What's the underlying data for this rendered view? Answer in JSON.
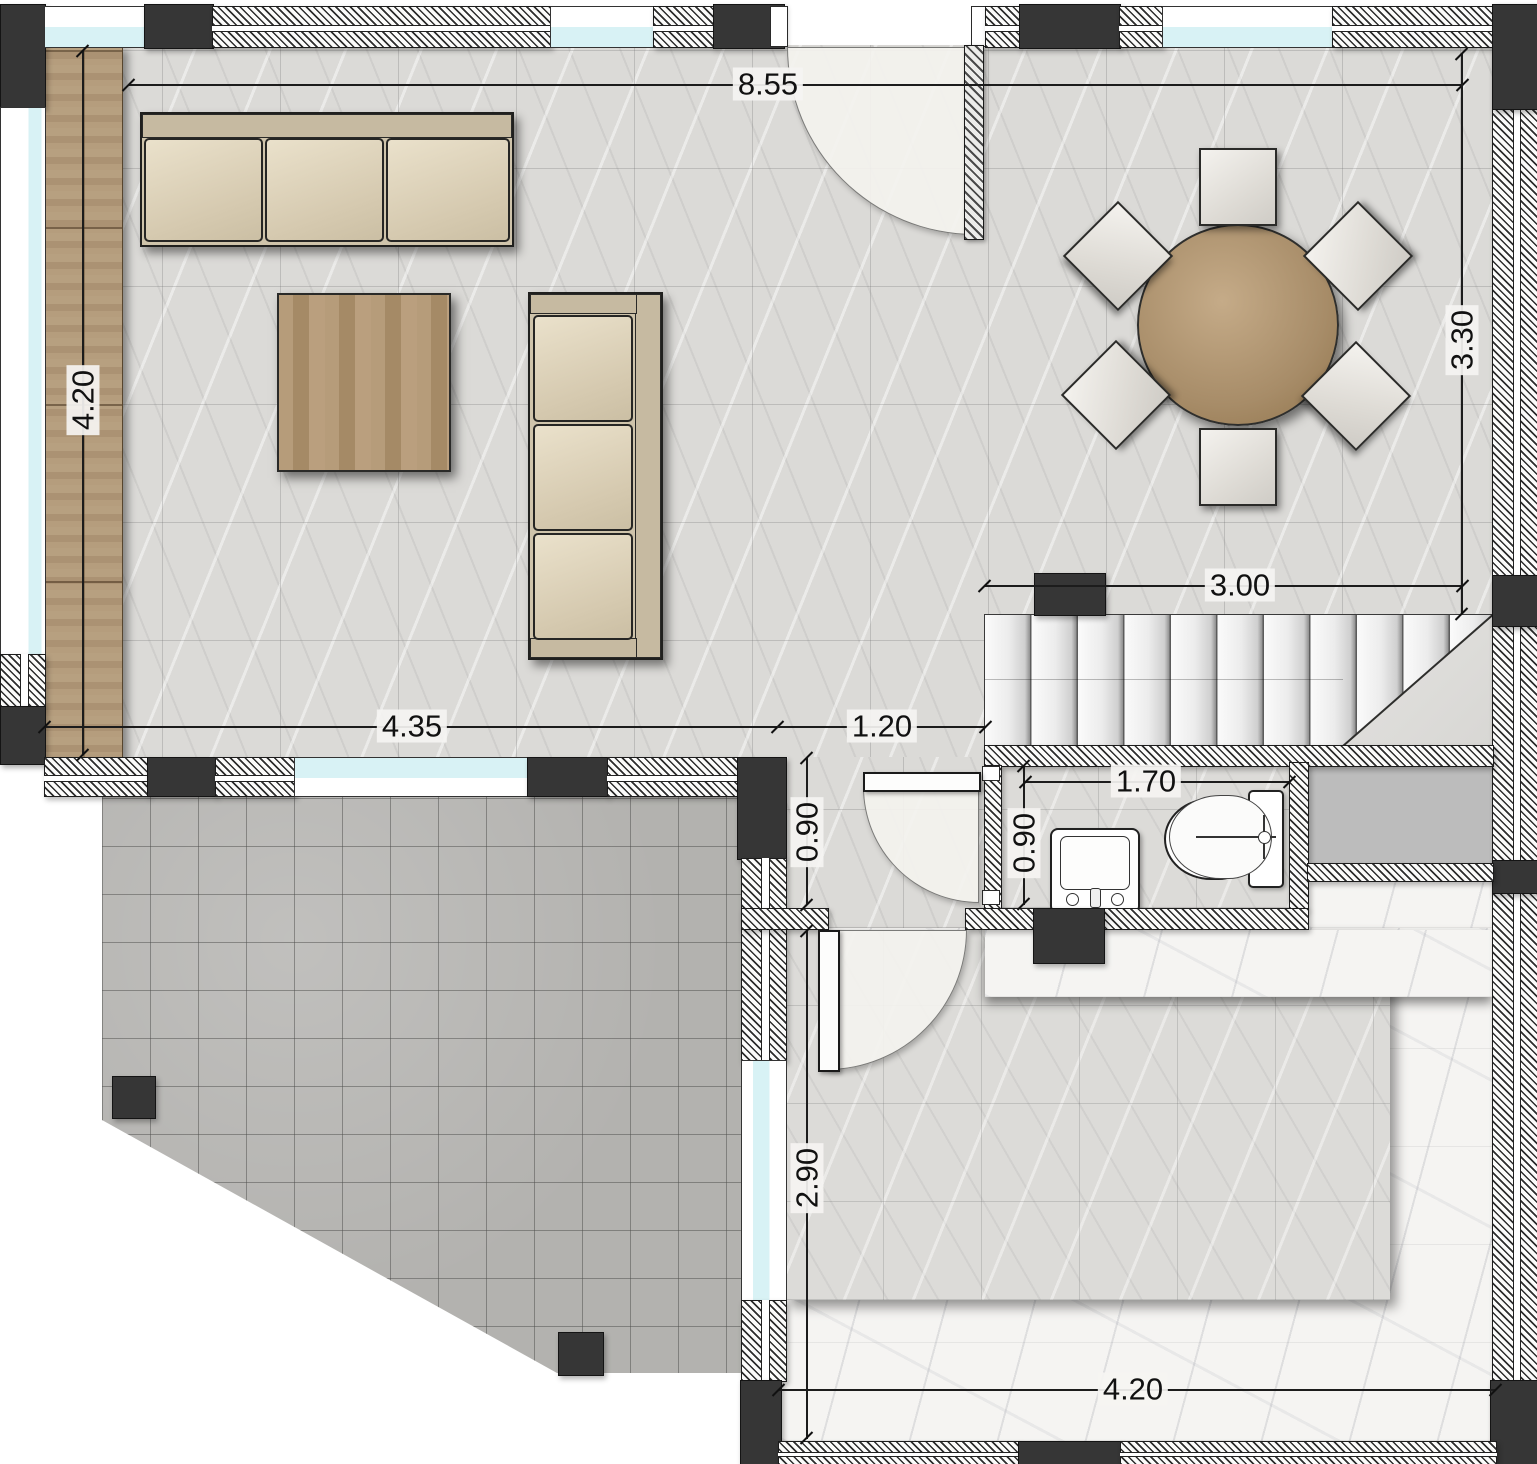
{
  "drawing": {
    "type": "architectural-floor-plan",
    "floor": "ground-floor-with-living-dining-stairs-wc-terrace"
  },
  "dims": {
    "top_width": "8.55",
    "left_height": "4.20",
    "right_height": "3.30",
    "stairs_width": "3.00",
    "living_bottom": "4.35",
    "hall_width": "1.20",
    "hall_depth": "0.90",
    "bath_depth": "0.90",
    "bath_width": "1.70",
    "room_depth": "2.90",
    "room_width": "4.20"
  },
  "colors": {
    "wall_hatch": "#2d2d2d",
    "column": "#363636",
    "window_glass": "#d8f2f5",
    "wood": "#b49c7c",
    "floor_tile": "#dbdad7",
    "patio_tile": "#b3b2af",
    "white_marble": "#f5f4f2",
    "shaft_gray": "#bcbcbc"
  }
}
